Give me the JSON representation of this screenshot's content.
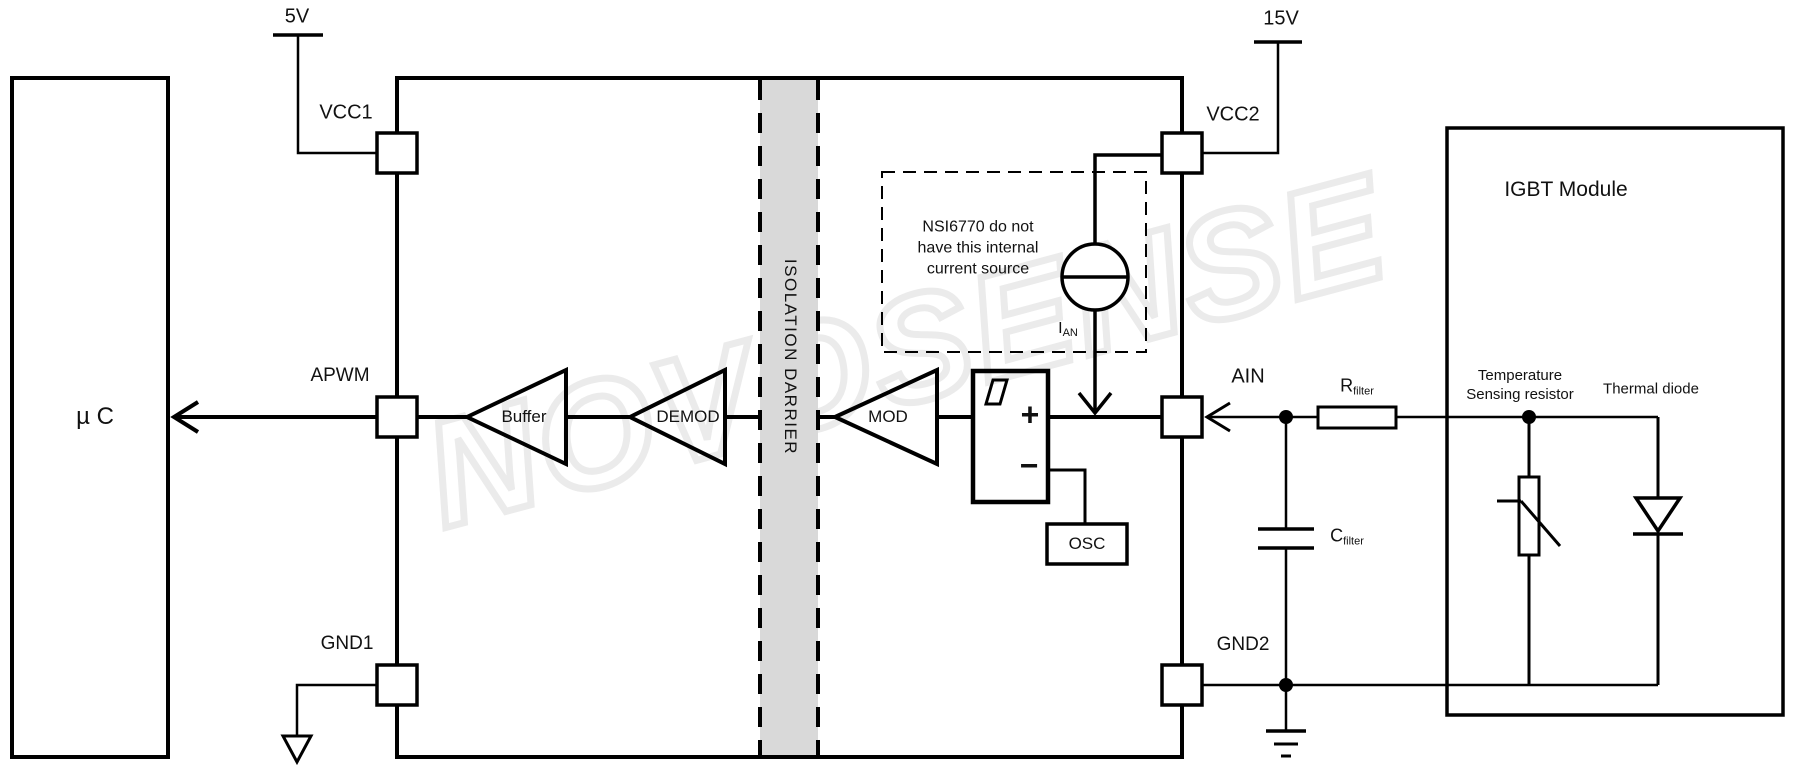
{
  "watermark": "NOVOSENSE",
  "colors": {
    "line": "#000000",
    "barrier_fill": "#d9d9d9",
    "watermark_outline": "#ebebeb",
    "background": "#ffffff"
  },
  "supplies": {
    "left_rail": "5V",
    "right_rail": "15V"
  },
  "mcu": {
    "label": "µ C"
  },
  "ic": {
    "pins": {
      "vcc1": "VCC1",
      "apwm": "APWM",
      "gnd1": "GND1",
      "vcc2": "VCC2",
      "ain": "AIN",
      "gnd2": "GND2"
    },
    "blocks": {
      "buffer": "Buffer",
      "demod": "DEMOD",
      "mod": "MOD",
      "osc": "OSC"
    },
    "isolation_barrier": "ISOLATION DARRIER",
    "comparator": {
      "plus": "+",
      "minus": "−"
    },
    "note": {
      "lines": [
        "NSI6770 do not",
        "have this internal",
        "current source"
      ]
    },
    "current_source": {
      "base": "I",
      "sub": "AN"
    }
  },
  "external": {
    "r_filter": {
      "base": "R",
      "sub": "filter"
    },
    "c_filter": {
      "base": "C",
      "sub": "filter"
    },
    "igbt_module": {
      "title": "IGBT Module",
      "thermistor_lines": [
        "Temperature",
        "Sensing resistor"
      ],
      "diode_label": "Thermal diode"
    }
  }
}
